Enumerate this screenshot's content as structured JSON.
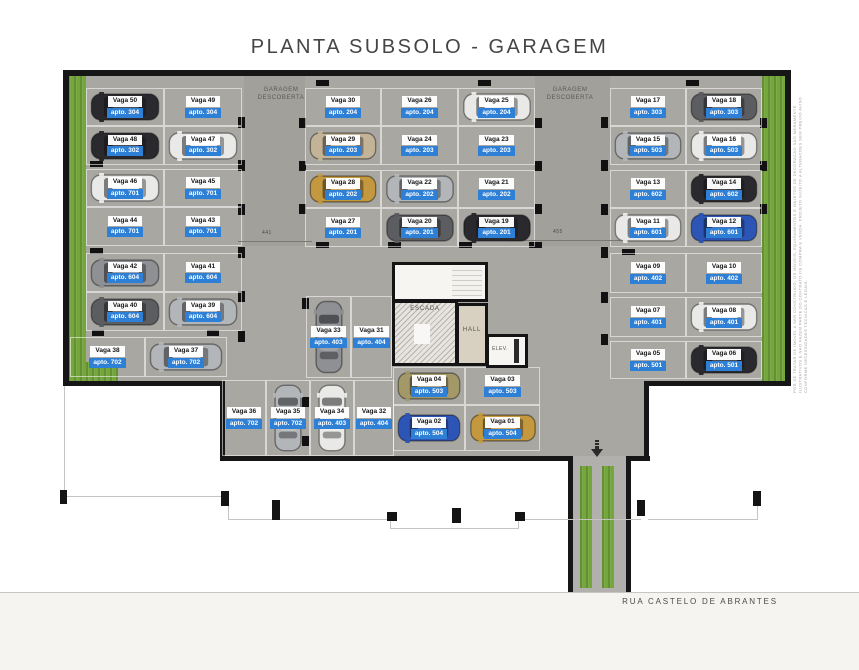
{
  "title": "PLANTA SUBSOLO - GARAGEM",
  "street_label": "RUA CASTELO DE ABRANTES",
  "plan_labels": {
    "garagem": "GARAGEM",
    "descoberta_line1": "GARAGEM",
    "descoberta_line2": "DESCOBERTA",
    "escada": "ESCADA",
    "hall": "HALL",
    "elev": "ELEV."
  },
  "dimensions": [
    {
      "text": "441",
      "tx": 262,
      "ty": 230,
      "lx": 238,
      "ly": 241,
      "lw": 74
    },
    {
      "text": "455",
      "tx": 553,
      "ty": 229,
      "lx": 508,
      "ly": 240,
      "lw": 112
    }
  ],
  "disclaimer": "POR SE TRATAR DE IMOVEL A SER CONSTRUIDO, OS MOVEIS, EQUIPAMENTOS E OBJETOS DE DECORACAO SAO MERAMENTE ILUSTRATIVOS E NAO FAZEM PARTE DO CONTRATO DE COMPRA E VENDA. PROJETO SUJEITO A ALTERACOES SEM PREVIO AVISO CONFORME NECESSIDADES TECNICAS E LEGAIS.",
  "colors": {
    "floor": "#a9a7a2",
    "wall": "#161616",
    "grass": "#74a63c",
    "apto_badge": "#2e7fd6",
    "vaga_badge": "#ffffff",
    "title_text": "#454545"
  },
  "car_colors": {
    "black": "#2a2a2e",
    "darkgray": "#5b5d60",
    "gray": "#8e9094",
    "silver": "#b3b6b8",
    "white": "#e9e9e7",
    "blue": "#2d55b6",
    "gold": "#c4983f",
    "tan": "#c4b497",
    "olive": "#a39868"
  },
  "stalls": [
    {
      "vaga": "Vaga 50",
      "apto": "apto. 304",
      "x": 86,
      "y": 88,
      "w": 78,
      "h": 38,
      "car": "black"
    },
    {
      "vaga": "Vaga 49",
      "apto": "apto. 304",
      "x": 164,
      "y": 88,
      "w": 78,
      "h": 38,
      "car": ""
    },
    {
      "vaga": "Vaga 48",
      "apto": "apto. 302",
      "x": 86,
      "y": 126,
      "w": 78,
      "h": 39,
      "car": "black"
    },
    {
      "vaga": "Vaga 47",
      "apto": "apto. 302",
      "x": 164,
      "y": 126,
      "w": 78,
      "h": 39,
      "car": "white"
    },
    {
      "vaga": "Vaga 46",
      "apto": "apto. 701",
      "x": 86,
      "y": 169,
      "w": 78,
      "h": 38,
      "car": "white"
    },
    {
      "vaga": "Vaga 45",
      "apto": "apto. 701",
      "x": 164,
      "y": 169,
      "w": 78,
      "h": 38,
      "car": ""
    },
    {
      "vaga": "Vaga 44",
      "apto": "apto. 701",
      "x": 86,
      "y": 207,
      "w": 78,
      "h": 39,
      "car": ""
    },
    {
      "vaga": "Vaga 43",
      "apto": "apto. 701",
      "x": 164,
      "y": 207,
      "w": 78,
      "h": 39,
      "car": ""
    },
    {
      "vaga": "Vaga 42",
      "apto": "apto. 604",
      "x": 86,
      "y": 253,
      "w": 78,
      "h": 39,
      "car": "gray"
    },
    {
      "vaga": "Vaga 41",
      "apto": "apto. 604",
      "x": 164,
      "y": 253,
      "w": 78,
      "h": 39,
      "car": ""
    },
    {
      "vaga": "Vaga 40",
      "apto": "apto. 604",
      "x": 86,
      "y": 292,
      "w": 78,
      "h": 39,
      "car": "darkgray"
    },
    {
      "vaga": "Vaga 39",
      "apto": "apto. 604",
      "x": 164,
      "y": 292,
      "w": 78,
      "h": 39,
      "car": "silver"
    },
    {
      "vaga": "Vaga 38",
      "apto": "apto. 702",
      "x": 70,
      "y": 337,
      "w": 75,
      "h": 40,
      "car": ""
    },
    {
      "vaga": "Vaga 37",
      "apto": "apto. 702",
      "x": 145,
      "y": 337,
      "w": 82,
      "h": 40,
      "car": "silver"
    },
    {
      "vaga": "Vaga 30",
      "apto": "apto. 204",
      "x": 305,
      "y": 88,
      "w": 76,
      "h": 38,
      "car": ""
    },
    {
      "vaga": "Vaga 26",
      "apto": "apto. 204",
      "x": 381,
      "y": 88,
      "w": 77,
      "h": 38,
      "car": ""
    },
    {
      "vaga": "Vaga 25",
      "apto": "apto. 204",
      "x": 458,
      "y": 88,
      "w": 77,
      "h": 38,
      "car": "white"
    },
    {
      "vaga": "Vaga 29",
      "apto": "apto. 203",
      "x": 305,
      "y": 126,
      "w": 76,
      "h": 39,
      "car": "tan"
    },
    {
      "vaga": "Vaga 24",
      "apto": "apto. 203",
      "x": 381,
      "y": 126,
      "w": 77,
      "h": 39,
      "car": ""
    },
    {
      "vaga": "Vaga 23",
      "apto": "apto. 203",
      "x": 458,
      "y": 126,
      "w": 77,
      "h": 39,
      "car": ""
    },
    {
      "vaga": "Vaga 28",
      "apto": "apto. 202",
      "x": 305,
      "y": 170,
      "w": 76,
      "h": 38,
      "car": "gold"
    },
    {
      "vaga": "Vaga 22",
      "apto": "apto. 202",
      "x": 381,
      "y": 170,
      "w": 77,
      "h": 38,
      "car": "silver"
    },
    {
      "vaga": "Vaga 21",
      "apto": "apto. 202",
      "x": 458,
      "y": 170,
      "w": 77,
      "h": 38,
      "car": ""
    },
    {
      "vaga": "Vaga 27",
      "apto": "apto. 201",
      "x": 305,
      "y": 208,
      "w": 76,
      "h": 39,
      "car": ""
    },
    {
      "vaga": "Vaga 20",
      "apto": "apto. 201",
      "x": 381,
      "y": 208,
      "w": 77,
      "h": 39,
      "car": "darkgray"
    },
    {
      "vaga": "Vaga 19",
      "apto": "apto. 201",
      "x": 458,
      "y": 208,
      "w": 77,
      "h": 39,
      "car": "black"
    },
    {
      "vaga": "Vaga 17",
      "apto": "apto. 303",
      "x": 610,
      "y": 88,
      "w": 76,
      "h": 38,
      "car": ""
    },
    {
      "vaga": "Vaga 18",
      "apto": "apto. 303",
      "x": 686,
      "y": 88,
      "w": 76,
      "h": 38,
      "car": "darkgray"
    },
    {
      "vaga": "Vaga 15",
      "apto": "apto. 503",
      "x": 610,
      "y": 126,
      "w": 76,
      "h": 39,
      "car": "silver"
    },
    {
      "vaga": "Vaga 16",
      "apto": "apto. 503",
      "x": 686,
      "y": 126,
      "w": 76,
      "h": 39,
      "car": "white"
    },
    {
      "vaga": "Vaga 13",
      "apto": "apto. 602",
      "x": 610,
      "y": 170,
      "w": 76,
      "h": 38,
      "car": ""
    },
    {
      "vaga": "Vaga 14",
      "apto": "apto. 602",
      "x": 686,
      "y": 170,
      "w": 76,
      "h": 38,
      "car": "black"
    },
    {
      "vaga": "Vaga 11",
      "apto": "apto. 601",
      "x": 610,
      "y": 208,
      "w": 76,
      "h": 39,
      "car": "white"
    },
    {
      "vaga": "Vaga 12",
      "apto": "apto. 601",
      "x": 686,
      "y": 208,
      "w": 76,
      "h": 39,
      "car": "blue"
    },
    {
      "vaga": "Vaga 09",
      "apto": "apto. 402",
      "x": 610,
      "y": 253,
      "w": 76,
      "h": 40,
      "car": ""
    },
    {
      "vaga": "Vaga 10",
      "apto": "apto. 402",
      "x": 686,
      "y": 253,
      "w": 76,
      "h": 40,
      "car": ""
    },
    {
      "vaga": "Vaga 07",
      "apto": "apto. 401",
      "x": 610,
      "y": 297,
      "w": 76,
      "h": 40,
      "car": ""
    },
    {
      "vaga": "Vaga 08",
      "apto": "apto. 401",
      "x": 686,
      "y": 297,
      "w": 76,
      "h": 40,
      "car": "white"
    },
    {
      "vaga": "Vaga 05",
      "apto": "apto. 501",
      "x": 610,
      "y": 341,
      "w": 76,
      "h": 38,
      "car": ""
    },
    {
      "vaga": "Vaga 06",
      "apto": "apto. 501",
      "x": 686,
      "y": 341,
      "w": 76,
      "h": 38,
      "car": "black"
    },
    {
      "vaga": "Vaga 33",
      "apto": "apto. 403",
      "x": 306,
      "y": 296,
      "w": 45,
      "h": 82,
      "car": "gray",
      "vert": true
    },
    {
      "vaga": "Vaga 31",
      "apto": "apto. 404",
      "x": 351,
      "y": 296,
      "w": 41,
      "h": 82,
      "car": "",
      "vert": true
    },
    {
      "vaga": "Vaga 36",
      "apto": "apto. 702",
      "x": 222,
      "y": 380,
      "w": 44,
      "h": 76,
      "car": "",
      "vert": true
    },
    {
      "vaga": "Vaga 35",
      "apto": "apto. 702",
      "x": 266,
      "y": 380,
      "w": 44,
      "h": 76,
      "car": "silver",
      "vert": true
    },
    {
      "vaga": "Vaga 34",
      "apto": "apto. 403",
      "x": 310,
      "y": 380,
      "w": 44,
      "h": 76,
      "car": "white",
      "vert": true
    },
    {
      "vaga": "Vaga 32",
      "apto": "apto. 404",
      "x": 354,
      "y": 380,
      "w": 40,
      "h": 76,
      "car": "",
      "vert": true
    },
    {
      "vaga": "Vaga 04",
      "apto": "apto. 503",
      "x": 393,
      "y": 367,
      "w": 72,
      "h": 38,
      "car": "olive"
    },
    {
      "vaga": "Vaga 03",
      "apto": "apto. 503",
      "x": 465,
      "y": 367,
      "w": 75,
      "h": 38,
      "car": ""
    },
    {
      "vaga": "Vaga 02",
      "apto": "apto. 504",
      "x": 393,
      "y": 405,
      "w": 72,
      "h": 46,
      "car": "blue"
    },
    {
      "vaga": "Vaga 01",
      "apto": "apto. 504",
      "x": 465,
      "y": 405,
      "w": 75,
      "h": 46,
      "car": "gold"
    }
  ]
}
